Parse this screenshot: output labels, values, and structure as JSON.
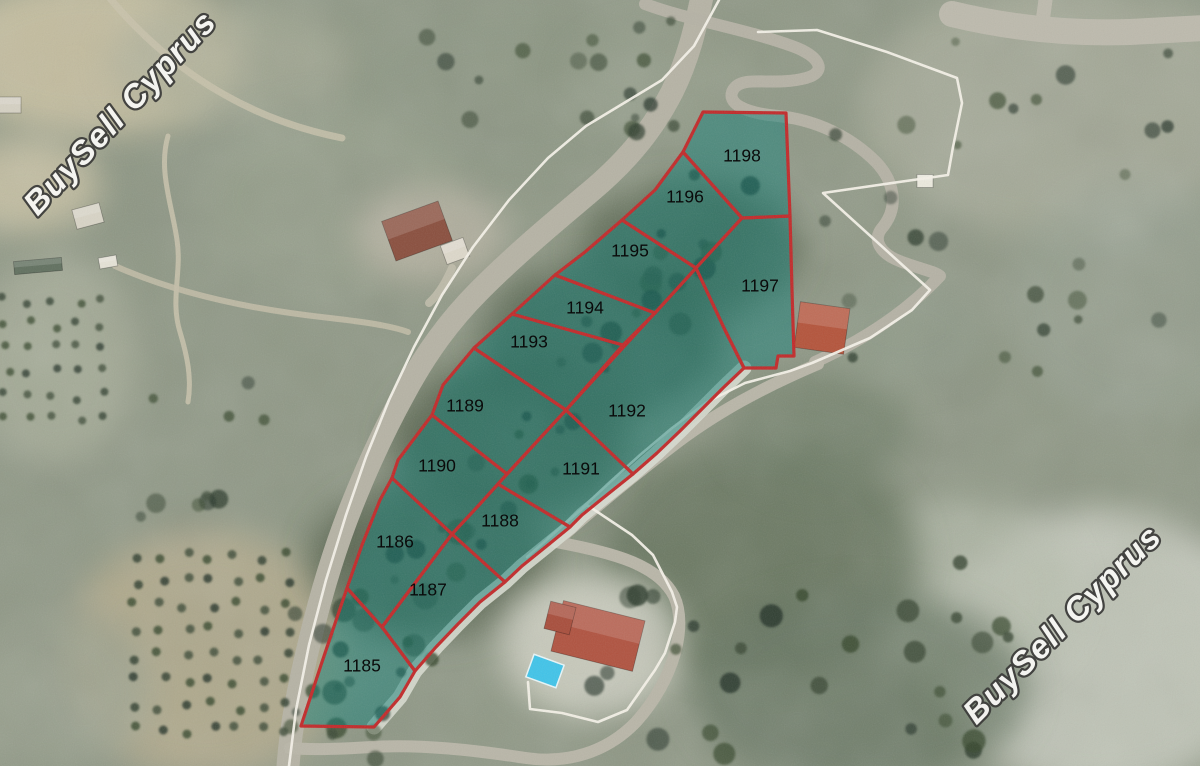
{
  "map": {
    "watermark": {
      "text": "BuySell Cyprus",
      "fill": "#f8f8f5",
      "outline": "#3d3d3b",
      "instances": [
        {
          "x": 128,
          "y": 120,
          "angle": -47
        },
        {
          "x": 1070,
          "y": 632,
          "angle": -45
        }
      ]
    },
    "plots": {
      "fill": "#0e7c74",
      "fill_opacity": 0.5,
      "stroke": "#c22a2a",
      "stroke_width": 3.2,
      "label_color": "#0a0a0a",
      "items": [
        {
          "number": "1185",
          "label": {
            "x": 362,
            "y": 667
          },
          "points": [
            [
              347,
              588
            ],
            [
              382,
              627
            ],
            [
              415,
              671
            ],
            [
              400,
              697
            ],
            [
              374,
              727
            ],
            [
              301,
              726
            ],
            [
              322,
              662
            ]
          ]
        },
        {
          "number": "1186",
          "label": {
            "x": 395,
            "y": 543
          },
          "points": [
            [
              392,
              478
            ],
            [
              452,
              534
            ],
            [
              382,
              627
            ],
            [
              347,
              588
            ],
            [
              362,
              545
            ],
            [
              380,
              500
            ]
          ]
        },
        {
          "number": "1187",
          "label": {
            "x": 428,
            "y": 591
          },
          "points": [
            [
              382,
              627
            ],
            [
              452,
              534
            ],
            [
              505,
              582
            ],
            [
              480,
              602
            ],
            [
              458,
              624
            ],
            [
              436,
              647
            ],
            [
              415,
              671
            ]
          ]
        },
        {
          "number": "1188",
          "label": {
            "x": 500,
            "y": 522
          },
          "points": [
            [
              452,
              534
            ],
            [
              479,
              505
            ],
            [
              498,
              484
            ],
            [
              570,
              527
            ],
            [
              548,
              545
            ],
            [
              522,
              566
            ],
            [
              505,
              582
            ]
          ]
        },
        {
          "number": "1189",
          "label": {
            "x": 465,
            "y": 407
          },
          "points": [
            [
              443,
              385
            ],
            [
              474,
              348
            ],
            [
              566,
              410
            ],
            [
              507,
              474
            ],
            [
              432,
              415
            ]
          ]
        },
        {
          "number": "1190",
          "label": {
            "x": 437,
            "y": 467
          },
          "points": [
            [
              432,
              415
            ],
            [
              507,
              474
            ],
            [
              479,
              505
            ],
            [
              452,
              534
            ],
            [
              392,
              478
            ],
            [
              398,
              460
            ]
          ]
        },
        {
          "number": "1191",
          "label": {
            "x": 581,
            "y": 470
          },
          "points": [
            [
              498,
              484
            ],
            [
              566,
              410
            ],
            [
              633,
              474
            ],
            [
              608,
              494
            ],
            [
              582,
              515
            ],
            [
              570,
              527
            ]
          ]
        },
        {
          "number": "1192",
          "label": {
            "x": 627,
            "y": 412
          },
          "points": [
            [
              566,
              410
            ],
            [
              696,
              268
            ],
            [
              725,
              330
            ],
            [
              744,
              368
            ],
            [
              723,
              388
            ],
            [
              702,
              409
            ],
            [
              680,
              431
            ],
            [
              657,
              453
            ],
            [
              633,
              474
            ]
          ]
        },
        {
          "number": "1193",
          "label": {
            "x": 529,
            "y": 343
          },
          "points": [
            [
              474,
              348
            ],
            [
              512,
              314
            ],
            [
              623,
              345
            ],
            [
              566,
              410
            ]
          ]
        },
        {
          "number": "1194",
          "label": {
            "x": 585,
            "y": 309
          },
          "points": [
            [
              512,
              314
            ],
            [
              555,
              275
            ],
            [
              655,
              313
            ],
            [
              623,
              345
            ]
          ]
        },
        {
          "number": "1195",
          "label": {
            "x": 630,
            "y": 252
          },
          "points": [
            [
              555,
              275
            ],
            [
              585,
              252
            ],
            [
              622,
              220
            ],
            [
              696,
              268
            ],
            [
              655,
              313
            ]
          ]
        },
        {
          "number": "1196",
          "label": {
            "x": 685,
            "y": 198
          },
          "points": [
            [
              622,
              220
            ],
            [
              655,
              190
            ],
            [
              683,
              152
            ],
            [
              742,
              218
            ],
            [
              696,
              268
            ]
          ]
        },
        {
          "number": "1197",
          "label": {
            "x": 760,
            "y": 287
          },
          "points": [
            [
              742,
              218
            ],
            [
              790,
              216
            ],
            [
              792,
              290
            ],
            [
              794,
              356
            ],
            [
              778,
              356
            ],
            [
              776,
              368
            ],
            [
              744,
              368
            ],
            [
              725,
              330
            ],
            [
              696,
              268
            ]
          ]
        },
        {
          "number": "1198",
          "label": {
            "x": 742,
            "y": 157
          },
          "points": [
            [
              683,
              152
            ],
            [
              703,
              112
            ],
            [
              786,
              113
            ],
            [
              790,
              216
            ],
            [
              742,
              218
            ]
          ]
        }
      ]
    },
    "white_boundaries": {
      "stroke": "#f4f1e8",
      "width": 2.6,
      "polylines": [
        [
          [
            719,
            0
          ],
          [
            694,
            46
          ],
          [
            662,
            80
          ],
          [
            624,
            103
          ],
          [
            586,
            126
          ],
          [
            548,
            158
          ],
          [
            509,
            200
          ],
          [
            473,
            247
          ],
          [
            442,
            295
          ],
          [
            414,
            347
          ],
          [
            389,
            400
          ],
          [
            366,
            457
          ],
          [
            346,
            515
          ],
          [
            326,
            580
          ],
          [
            309,
            645
          ],
          [
            296,
            710
          ],
          [
            289,
            766
          ]
        ],
        [
          [
            758,
            32
          ],
          [
            817,
            30
          ],
          [
            887,
            52
          ],
          [
            957,
            78
          ],
          [
            962,
            103
          ],
          [
            953,
            147
          ],
          [
            948,
            175
          ],
          [
            823,
            193
          ],
          [
            930,
            290
          ],
          [
            912,
            310
          ],
          [
            870,
            338
          ],
          [
            812,
            363
          ],
          [
            790,
            371
          ],
          [
            745,
            383
          ],
          [
            707,
            402
          ],
          [
            672,
            428
          ],
          [
            640,
            455
          ],
          [
            610,
            482
          ],
          [
            580,
            510
          ],
          [
            550,
            537
          ],
          [
            527,
            557
          ]
        ],
        [
          [
            548,
            538
          ],
          [
            587,
            505
          ],
          [
            632,
            535
          ],
          [
            653,
            555
          ],
          [
            672,
            592
          ],
          [
            677,
            607
          ],
          [
            675,
            622
          ],
          [
            665,
            653
          ],
          [
            655,
            670
          ],
          [
            627,
            710
          ],
          [
            598,
            722
          ],
          [
            562,
            713
          ],
          [
            530,
            709
          ],
          [
            528,
            682
          ]
        ]
      ]
    },
    "roads": [
      {
        "path": "M 703,-8 C 695,30 688,60 672,92 C 650,135 622,165 590,192 C 552,224 515,255 480,290 C 448,322 425,355 405,392 C 385,428 368,465 352,505 C 336,545 322,590 310,640 C 299,685 291,725 288,766",
        "width": 23,
        "color": "#b6b3a5"
      },
      {
        "path": "M 645,4 C 688,20 742,28 792,46 C 820,56 828,72 806,78 C 772,87 742,74 733,90 C 726,103 744,113 778,116 C 818,120 852,138 876,162 C 895,182 899,208 882,228 C 872,240 880,254 902,262 C 924,270 936,272 940,276 C 910,308 868,338 815,362",
        "width": 12,
        "color": "#b5b2a5"
      },
      {
        "path": "M 952,14 C 1010,28 1070,34 1130,32 L 1204,28",
        "width": 26,
        "color": "#bdbaad"
      },
      {
        "path": "M 1046,-4 L 1042,26",
        "width": 14,
        "color": "#bdbaad"
      },
      {
        "path": "M 818,364 C 766,386 716,412 670,448 C 628,480 590,512 556,542",
        "width": 12,
        "color": "#b9b6a8"
      },
      {
        "path": "M 556,542 C 615,553 658,565 674,596 C 688,626 674,680 636,722 C 606,753 566,764 526,758 C 473,750 420,744 372,747 C 338,749 312,750 290,748",
        "width": 12,
        "color": "#b9b6a8"
      },
      {
        "path": "M 168,136 C 158,170 172,205 177,240 C 182,272 170,300 180,332 C 187,355 192,378 188,402",
        "width": 5,
        "color": "#c7c1ab",
        "opacity": 0.9
      },
      {
        "path": "M 115,266 C 180,295 255,310 330,318 C 365,322 392,326 408,332",
        "width": 6,
        "color": "#c3bda8",
        "opacity": 0.85
      },
      {
        "path": "M 108,-4 C 140,35 180,70 225,95 C 262,116 302,130 342,138",
        "width": 7,
        "color": "#c9c3ac",
        "opacity": 0.8
      },
      {
        "path": "M 452,268 C 445,284 437,296 429,303",
        "width": 8,
        "color": "#c0bcab",
        "opacity": 0.9
      }
    ],
    "beach_strip": {
      "color": "#d8dcd0",
      "width": 15,
      "points": [
        [
          374,
          727
        ],
        [
          400,
          697
        ],
        [
          415,
          671
        ],
        [
          436,
          647
        ],
        [
          458,
          624
        ],
        [
          480,
          602
        ],
        [
          505,
          582
        ],
        [
          522,
          566
        ],
        [
          548,
          545
        ],
        [
          570,
          527
        ],
        [
          582,
          515
        ],
        [
          608,
          494
        ],
        [
          633,
          474
        ],
        [
          657,
          453
        ],
        [
          680,
          431
        ],
        [
          702,
          409
        ],
        [
          723,
          388
        ],
        [
          744,
          368
        ]
      ]
    },
    "buildings": [
      {
        "name": "house-north",
        "x": 417,
        "y": 231,
        "w": 60,
        "h": 42,
        "rot": -20,
        "roof": "#8a4f3e"
      },
      {
        "name": "house-north-annex",
        "x": 455,
        "y": 251,
        "w": 24,
        "h": 20,
        "rot": -20,
        "roof": "#ddd8ca"
      },
      {
        "name": "house-east",
        "x": 822,
        "y": 328,
        "w": 50,
        "h": 46,
        "rot": 8,
        "roof": "#b4543b"
      },
      {
        "name": "villa-pool-house",
        "x": 598,
        "y": 636,
        "w": 84,
        "h": 52,
        "rot": 14,
        "roof": "#b05340"
      },
      {
        "name": "villa-wing",
        "x": 560,
        "y": 618,
        "w": 26,
        "h": 28,
        "rot": 14,
        "roof": "#a84e3c"
      },
      {
        "name": "white-shed",
        "x": 925,
        "y": 181,
        "w": 16,
        "h": 13,
        "rot": 0,
        "roof": "#eceade"
      },
      {
        "name": "shed-a",
        "x": 88,
        "y": 216,
        "w": 28,
        "h": 20,
        "rot": -15,
        "roof": "#d8d4c6"
      },
      {
        "name": "shed-b",
        "x": 108,
        "y": 262,
        "w": 18,
        "h": 11,
        "rot": -10,
        "roof": "#e5e2d6"
      },
      {
        "name": "greenhouse",
        "x": 38,
        "y": 266,
        "w": 48,
        "h": 13,
        "rot": -5,
        "roof": "#61705f"
      },
      {
        "name": "shed-c",
        "x": 8,
        "y": 105,
        "w": 26,
        "h": 16,
        "rot": 0,
        "roof": "#d5d1c3"
      }
    ],
    "pool": {
      "x": 545,
      "y": 671,
      "w": 32,
      "h": 24,
      "rot": 20,
      "color": "#41c4e9"
    }
  }
}
